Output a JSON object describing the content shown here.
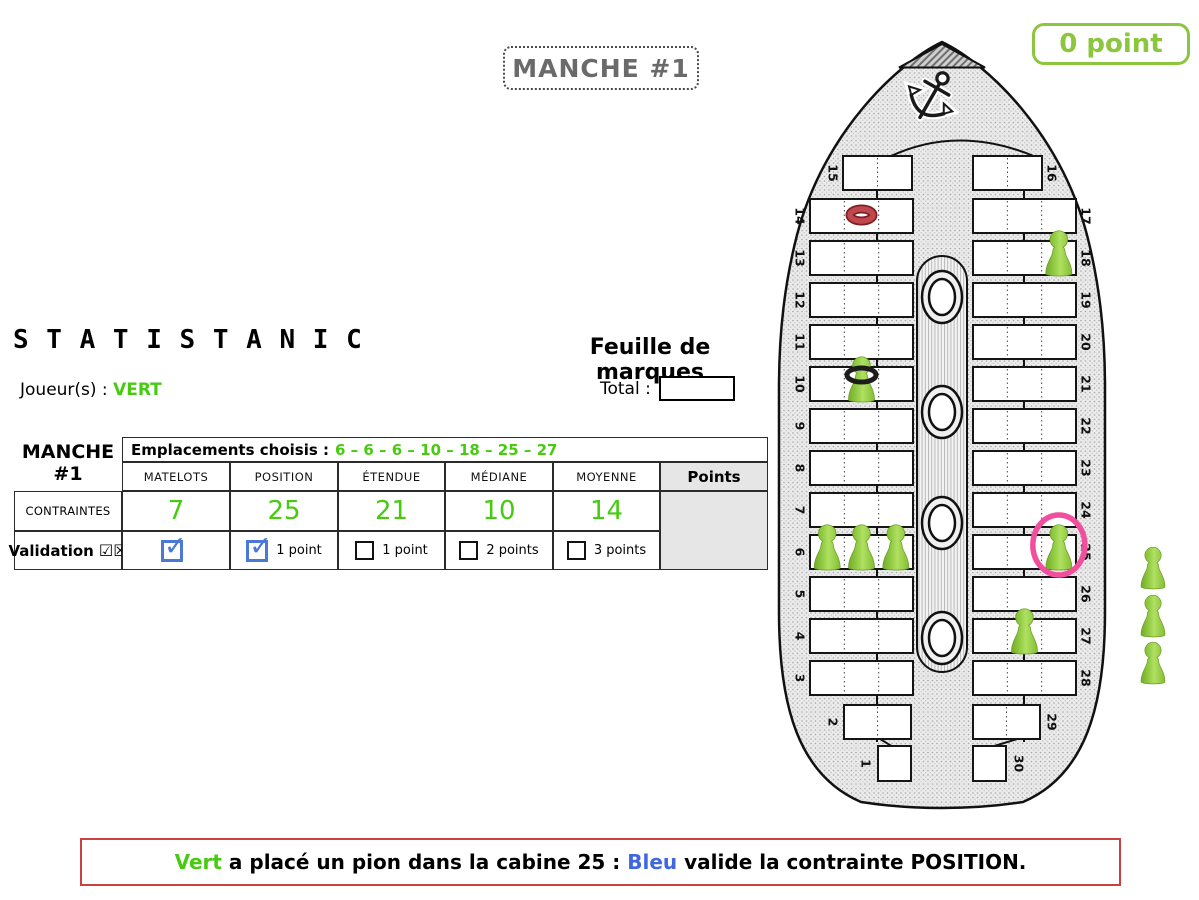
{
  "colors": {
    "green": "#46CB10",
    "lime": "#8CC63F",
    "blue": "#4066E0",
    "red": "#CC4040",
    "pink": "#F14F9D",
    "cbblue": "#4a79d6",
    "pawn": "#8CC63E"
  },
  "round_badge": {
    "label": "MANCHE #1"
  },
  "score_badge": {
    "label": "0 point"
  },
  "title": "S T A T I S T A N I C",
  "player": {
    "label": "Joueur(s) :",
    "name": "VERT"
  },
  "sheet": {
    "heading": "Feuille de marques",
    "total_label": "Total :",
    "total_value": ""
  },
  "table": {
    "round_label": "MANCHE",
    "round_number": "#1",
    "emplacements_label": "Emplacements choisis :",
    "emplacements_values": "6 – 6 – 6 – 10 – 18 – 25 – 27",
    "columns": [
      "MATELOTS",
      "POSITION",
      "ÉTENDUE",
      "MÉDIANE",
      "MOYENNE"
    ],
    "points_header": "Points",
    "constraints_label": "CONTRAINTES",
    "constraints_values": [
      "7",
      "25",
      "21",
      "10",
      "14"
    ],
    "validation_label": "Validation",
    "validation_glyphs": "☑☒",
    "validation_cells": [
      {
        "checked": true,
        "label": ""
      },
      {
        "checked": true,
        "label": "1 point"
      },
      {
        "checked": false,
        "label": "1 point"
      },
      {
        "checked": false,
        "label": "2 points"
      },
      {
        "checked": false,
        "label": "3 points"
      }
    ]
  },
  "ship": {
    "left_cabins": [
      15,
      14,
      13,
      12,
      11,
      10,
      9,
      8,
      7,
      6,
      5,
      4,
      3,
      2,
      1
    ],
    "right_cabins": [
      16,
      17,
      18,
      19,
      20,
      21,
      22,
      23,
      24,
      25,
      26,
      27,
      28,
      29,
      30
    ],
    "placements": [
      {
        "cabin": 6,
        "slot": 0
      },
      {
        "cabin": 6,
        "slot": 1
      },
      {
        "cabin": 6,
        "slot": 2
      },
      {
        "cabin": 10,
        "slot": 1,
        "marker": "black-ring"
      },
      {
        "cabin": 18,
        "slot": 2
      },
      {
        "cabin": 25,
        "slot": 2,
        "marker": "pink-circle"
      },
      {
        "cabin": 27,
        "slot": 1
      }
    ],
    "tokens": [
      {
        "type": "red-ring",
        "cabin": 14,
        "slot": 1
      }
    ],
    "reserve_pawns": 3
  },
  "message": {
    "parts": [
      {
        "text": "Vert",
        "color": "#46CB10",
        "name": "message-player-green"
      },
      {
        "text": " a placé un pion dans la cabine 25 : ",
        "color": null,
        "name": "message-text"
      },
      {
        "text": "Bleu",
        "color": "#4066E0",
        "name": "message-player-blue"
      },
      {
        "text": " valide la contrainte POSITION.",
        "color": null,
        "name": "message-text"
      }
    ]
  }
}
